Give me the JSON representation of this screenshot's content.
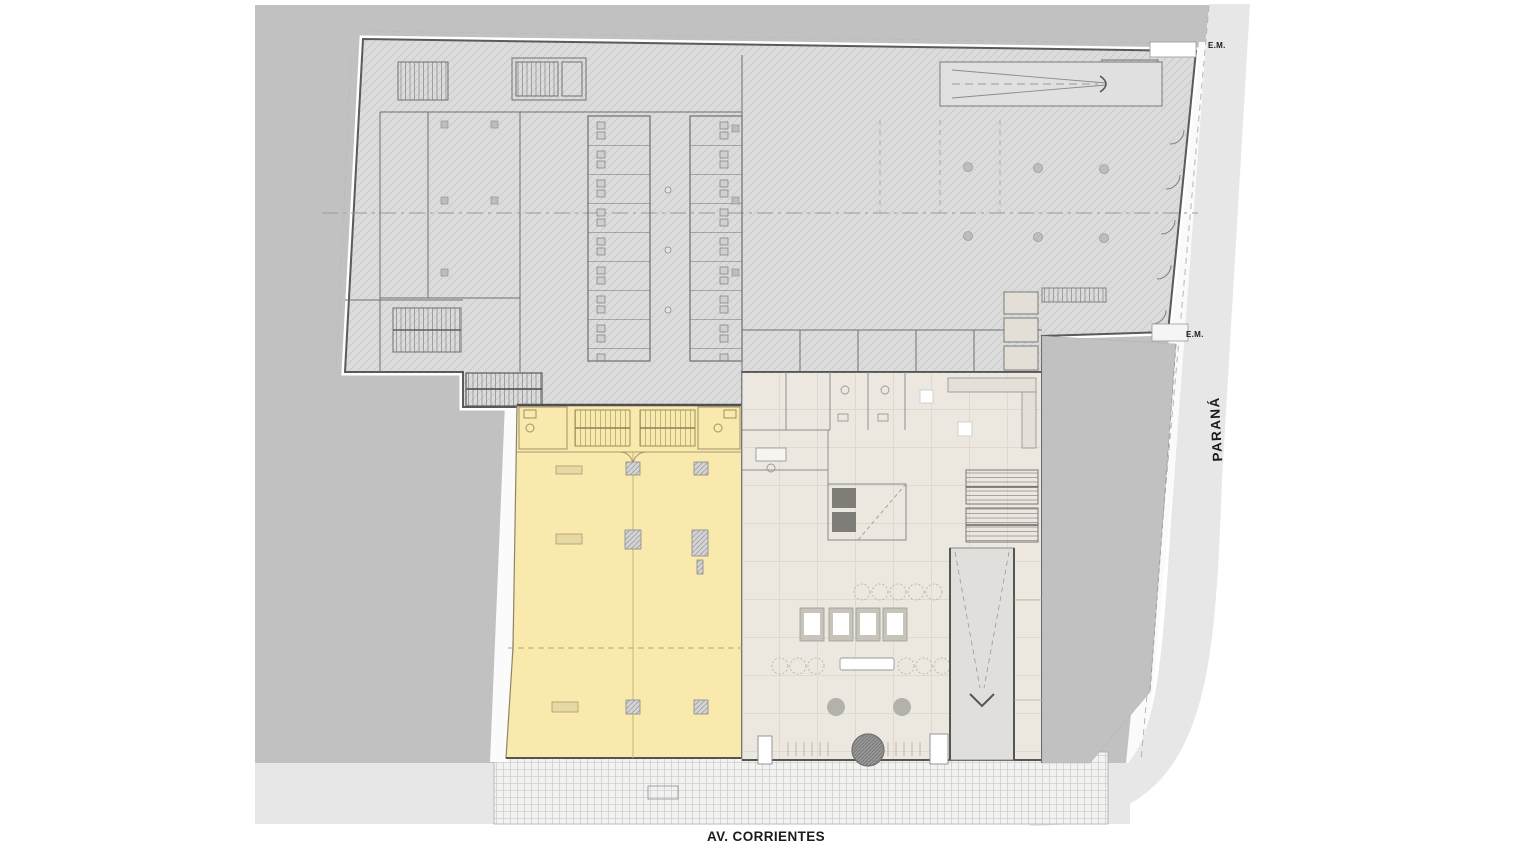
{
  "labels": {
    "street_bottom": "AV. CORRIENTES",
    "street_right": "PARANÁ",
    "em_top": "E.M.",
    "em_mid": "E.M."
  },
  "colors": {
    "surrounding_lots": "#c1c1c1",
    "street": "#e7e7e7",
    "sidewalk": "#f2f2f1",
    "building_fill": "#dcdcdc",
    "wall_dark": "#555555",
    "highlight_unit": "#f9e9ac",
    "lobby_floor": "#ece8e0",
    "ramp": "#e0dfdc"
  }
}
